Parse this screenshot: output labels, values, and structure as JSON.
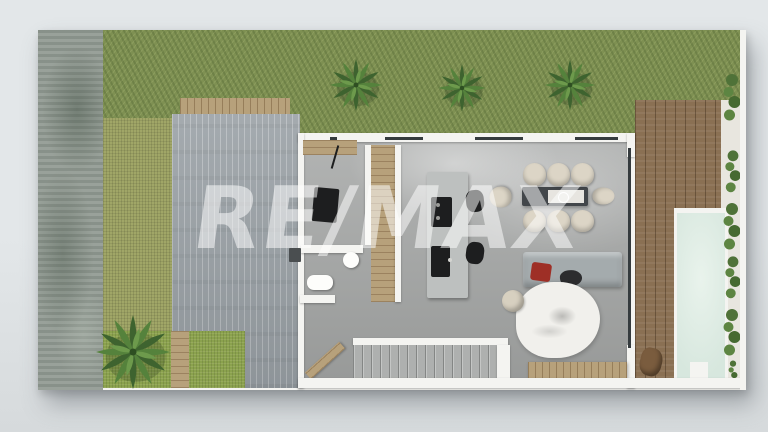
{
  "watermark": {
    "text": "RE/MAX"
  },
  "colors": {
    "background": "#e3e7e9",
    "background_bottom": "#d6dadc",
    "plan_shadow": "rgba(90,97,104,0.45)",
    "concrete_wall": "#919a92",
    "grass": "#7e9052",
    "hedge": "#a0a667",
    "lawn": "#8ba24e",
    "driveway": "#9aa1a6",
    "deck": "#8a7053",
    "pool": "#d7e7de",
    "walkway": "#e8e6df",
    "wall_white": "#f4f4f1",
    "floor": "#a9abaa",
    "wood": "#b7a17b",
    "island": "#bdc0bf",
    "appliance_black": "#1d1e1f",
    "chair": "#dcd5c6",
    "sofa": "#a4abad",
    "red": "#9e2f26",
    "rug": "#f1f0ec",
    "stairs": "#aeb0af",
    "plant": "#4f7238",
    "glass": "#353b3e",
    "watermark": "rgba(255,255,255,0.52)"
  }
}
